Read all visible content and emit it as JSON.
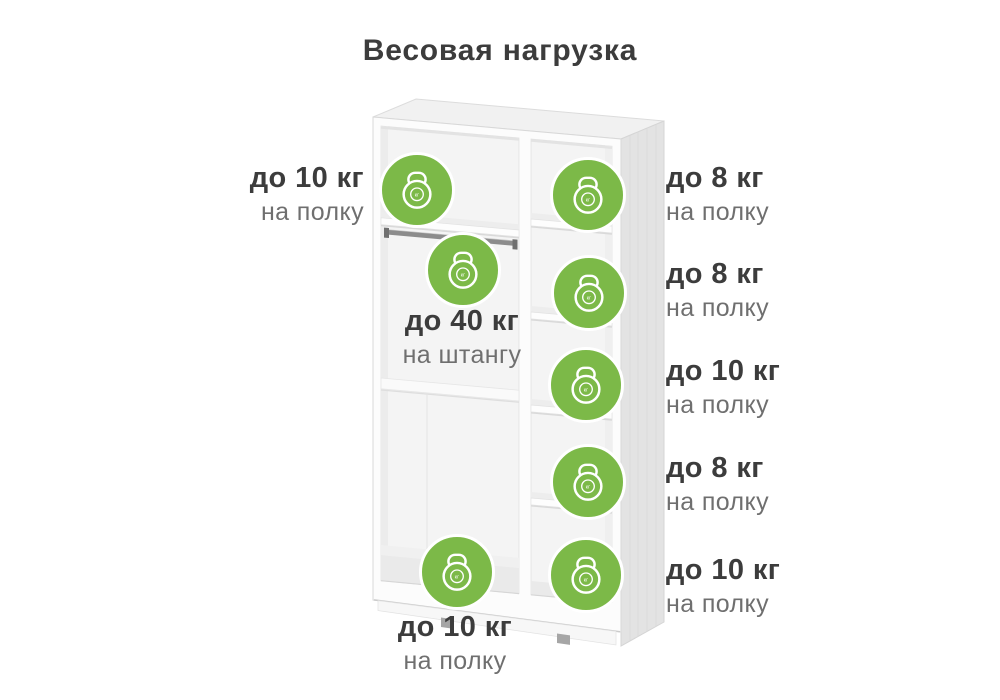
{
  "title": "Весовая нагрузка",
  "colors": {
    "accent": "#7cb948",
    "text_dark": "#3c3c3c",
    "text_muted": "#6f6f6f"
  },
  "kettlebell": {
    "unit": "кг"
  },
  "labels": {
    "top_shelf": {
      "weight": "до 10 кг",
      "location": "на полку"
    },
    "rod": {
      "weight": "до 40 кг",
      "location": "на штангу"
    },
    "bottom_shelf": {
      "weight": "до 10 кг",
      "location": "на полку"
    },
    "right_shelves": [
      {
        "weight": "до 8 кг",
        "location": "на полку"
      },
      {
        "weight": "до 8 кг",
        "location": "на полку"
      },
      {
        "weight": "до 10 кг",
        "location": "на полку"
      },
      {
        "weight": "до 8 кг",
        "location": "на полку"
      },
      {
        "weight": "до 10 кг",
        "location": "на полку"
      }
    ]
  }
}
